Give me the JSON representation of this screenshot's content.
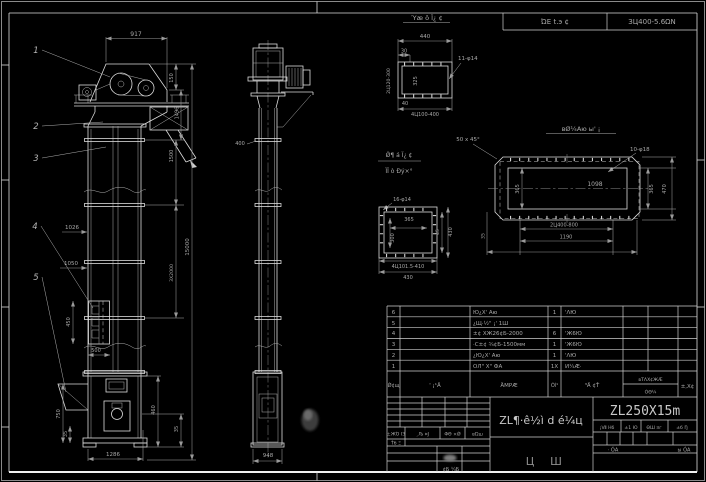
{
  "header": {
    "left_cell": "ΏΕ t.э ¢",
    "right_cell": "ЗЦ400-5.6ΩΝ"
  },
  "front": {
    "balloons": [
      "1",
      "2",
      "3",
      "4",
      "5"
    ],
    "dims": {
      "w917": "917",
      "h150": "150",
      "h1496": "1496",
      "h1500": "1500",
      "h3x2000": "3Х2000",
      "total": "15000",
      "l1026": "1026",
      "l1050": "1050",
      "bucket_h": "450",
      "bucket_w": "500",
      "boot_h": "750",
      "boot_s": "35",
      "base_w": "1286",
      "boot_r": "460",
      "boot_r2": "35"
    }
  },
  "side": {
    "dims": {
      "w400": "400",
      "base_w": "948"
    }
  },
  "detail_top": {
    "title": "Ύæ ô Ï¿ ¢",
    "dims": {
      "w440": "440",
      "w30": "30",
      "h325": "325",
      "holes": "11-φ14",
      "left_note": "2Ц120-300",
      "w40": "40",
      "bolts": "4Ц100-400"
    }
  },
  "detail_flange": {
    "title": "вØ¼Аю ы' ¡",
    "dims": {
      "chamfer": "50 x 45°",
      "holes": "10-φ18",
      "w1098": "1098",
      "h365i": "365",
      "h365": "365",
      "h470": "470",
      "bolts": "2Ц400-800",
      "w1190": "1190",
      "s35": "35"
    }
  },
  "detail_base": {
    "title_line1": "Ǿ¶ á Ï¿ ¢",
    "title_line2": "ÏÏ ò Ðý×°",
    "dims": {
      "holes": "16-φ14",
      "w365": "365",
      "h300": "300",
      "h45": "45",
      "h430": "430",
      "bolts": "4Ц101.5-410",
      "w430": "430"
    }
  },
  "bom": {
    "headers": {
      "no": "Ǿ¢щ",
      "code": "' ¡¹Ä",
      "name": "ÄΜΡÆ",
      "qty": "Óî¹",
      "material": "³Ä ¢Ť",
      "std_top": "вΤΛХ¢ЖÆ",
      "std_bottom": "ÓΘ¼",
      "note": "±,Х¢"
    },
    "rows": [
      {
        "no": "6",
        "name": "Ю¿Х' Аю",
        "qty": "1",
        "material": "'ΛЮ"
      },
      {
        "no": "5",
        "name": "¿Щ·½\" ¡' 1Ш",
        "qty": "",
        "material": ""
      },
      {
        "no": "4",
        "name": "±¢ ХЖ26¢Б-2000",
        "qty": "6",
        "material": "'Ж6Ю"
      },
      {
        "no": "3",
        "name": "·С±¢ ¾¢Б-1500мм",
        "qty": "1",
        "material": "'Ж6Ю"
      },
      {
        "no": "2",
        "name": "¿Ю¿Х' Аю",
        "qty": "1",
        "material": "'ΛЮ"
      },
      {
        "no": "1",
        "name": "ОЛ\" Х\" ФА",
        "qty": "1Х",
        "material": "И¼Æ·"
      }
    ]
  },
  "title_block": {
    "title": "ZL¶·ê½ì d é¼ц",
    "drawing_no": "ZL250X15m",
    "stamp1": "Ц",
    "stamp2": "Ш",
    "approval_labels": [
      "±ЖΌ ΙЗ",
      "¸Љ ¤Ј",
      "ΦΘ ×Ǿ",
      "вΏш"
    ],
    "row_b": "Ťб Ξ",
    "bottom_left": "¢Б ¼Б",
    "info_labels": [
      "¡Ⅶ Нб",
      "±1 Ю",
      "ΘШ ¤г",
      "±б Ŋ"
    ],
    "sheet1": "· ÓА",
    "sheet2": "ы ÓА"
  }
}
